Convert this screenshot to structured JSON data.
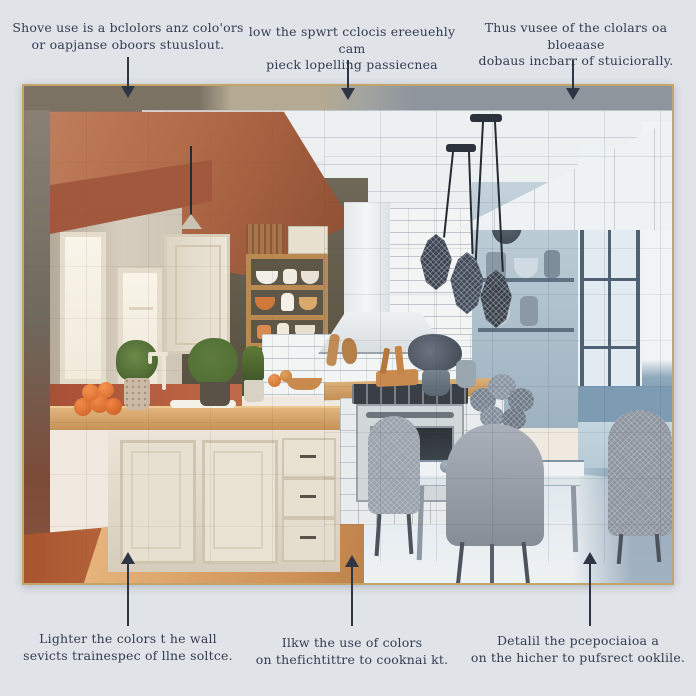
{
  "background_color": "#e0e3e8",
  "frame": {
    "border_color": "#c3a469"
  },
  "palette": {
    "annotation_text": "#333c50",
    "arrow": "#2e3645",
    "terracotta_ceiling": "#a85f42",
    "warm_wall_beige": "#cfc5b6",
    "accent_terracotta": "#a85036",
    "cabinet_cream": "#e9e2d4",
    "counter_wood": "#d9a86a",
    "floor_terracotta": "#b8653f",
    "floor_wood": "#d9a96c",
    "tile_white": "#f3f5f5",
    "wireframe_blue_wall": "#8fa9bc",
    "blue_wainscot": "#7d9cb4",
    "chair_gray": "#9aa1ab",
    "pendant_dark": "#3d4450"
  },
  "annotations": {
    "top": [
      {
        "line1": "Shove use is a bclolors anz colo'ors",
        "line2": "or oapjanse oboors stuuslout."
      },
      {
        "line1": "low the spwrt cclocis ereeuehly cam",
        "line2": "pieck lopelling passiecnea"
      },
      {
        "line1": "Thus vusee of the clolars oa bloeaase",
        "line2": "dobaus incbarr of stuiciorally."
      }
    ],
    "bottom": [
      {
        "line1": "Lighter the colors t he wall",
        "line2": "sevicts trainespec of llne soltce."
      },
      {
        "line1": "Ilkw the use of colors",
        "line2": "on thefichtittre to cooknai kt."
      },
      {
        "line1": "Detalil the pcepociaioa a",
        "line2": "on the hicher to pufsrect ooklile."
      }
    ]
  }
}
